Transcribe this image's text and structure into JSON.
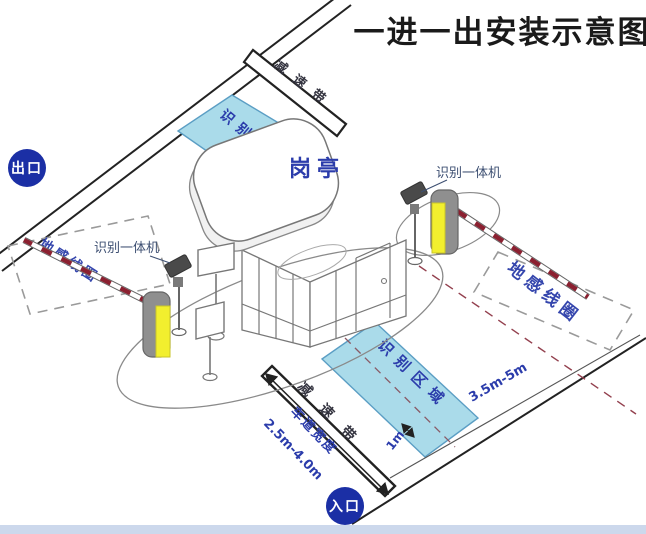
{
  "title": "一进一出安装示意图",
  "badges": {
    "exit": "出口",
    "entrance": "入口"
  },
  "booth": {
    "label": "岗亭"
  },
  "zones": {
    "recognition_exit": "识别区域",
    "recognition_entry": "识别区域",
    "speed_bump_exit": "减速带",
    "speed_bump_entry": "减速带",
    "ground_coil_exit": "地感线圈",
    "ground_coil_entry": "地感线圈"
  },
  "devices": {
    "reader_exit": "识别一体机",
    "reader_entry": "识别一体机"
  },
  "dimensions": {
    "lane_width_label": "车道宽度",
    "lane_width_value": "2.5m-4.0m",
    "coil_distance": "3.5m-5m",
    "center_offset": "1m"
  },
  "colors": {
    "badge_blue": "#1b2fa5",
    "label_blue": "#2b3cab",
    "zone_fill": "#aadbea",
    "zone_border": "#5b9ec4",
    "barrier_yellow": "#f2ef2e",
    "arm_red": "#8b2030",
    "road_line": "#222222"
  }
}
